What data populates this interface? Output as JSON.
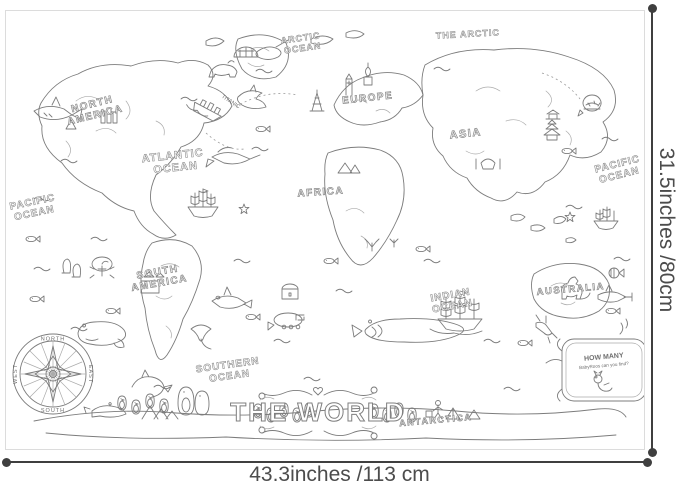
{
  "poster": {
    "description": "black-and-white line-art coloring poster of the world map",
    "line_color": "#7c7c7c",
    "labels": {
      "arctic_ocean_line1": "ARCTIC",
      "arctic_ocean_line2": "OCEAN",
      "the_arctic": "THE ARCTIC",
      "north_america_line1": "NORTH",
      "north_america_line2": "AMERICA",
      "europe": "EUROPE",
      "asia": "ASIA",
      "africa": "AFRICA",
      "south_america_line1": "SOUTH",
      "south_america_line2": "AMERICA",
      "australia": "AUSTRALIA",
      "atlantic_ocean_line1": "ATLANTIC",
      "atlantic_ocean_line2": "OCEAN",
      "pacific_ocean_west_line1": "PACIFIC",
      "pacific_ocean_west_line2": "OCEAN",
      "pacific_ocean_east_line1": "PACIFIC",
      "pacific_ocean_east_line2": "OCEAN",
      "indian_ocean_line1": "INDIAN",
      "indian_ocean_line2": "OCEAN",
      "southern_ocean_line1": "SOUTHERN",
      "southern_ocean_line2": "OCEAN",
      "antarctica": "ANTARCTICA",
      "title": "THE WORLD",
      "ship_name": "TITANIC"
    },
    "compass": {
      "north": "NORTH",
      "south": "SOUTH",
      "east": "EAST",
      "west": "WEST"
    },
    "how_many_box": {
      "line1": "HOW MANY",
      "line2": "BabyRoos can you find?"
    }
  },
  "dimensions": {
    "width_label": "43.3inches /113 cm",
    "height_label": "31.5inches /80cm",
    "line_color": "#3f3f3f",
    "text_color": "#4c4c4c"
  }
}
